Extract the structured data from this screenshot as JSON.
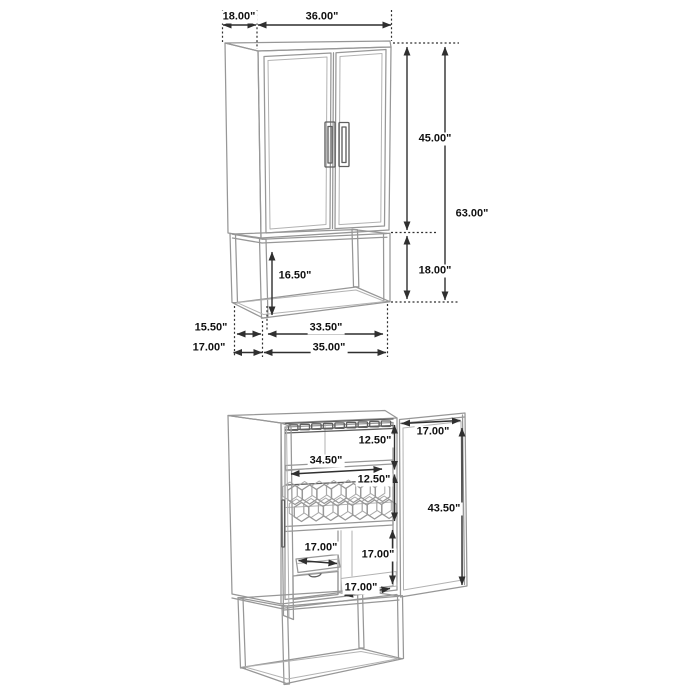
{
  "diagram_title": "bar cabinet dimension drawing, closed and open views",
  "colors": {
    "background": "#ffffff",
    "furniture_line": "#979797",
    "furniture_detail_line": "#5f5f5f",
    "dimension_line": "#2f2f2f",
    "label_text": "#111111"
  },
  "closed_view": {
    "top_depth": "18.00\"",
    "top_width": "36.00\"",
    "upper_section_height": "45.00\"",
    "overall_height": "63.00\"",
    "base_opening_height": "16.50\"",
    "base_section_height": "18.00\"",
    "base_depth_inner": "15.50\"",
    "base_depth_overall": "17.00\"",
    "base_width_inner": "33.50\"",
    "base_width_overall": "35.00\""
  },
  "open_view": {
    "door_width": "17.00\"",
    "stemware_section_height": "12.50\"",
    "interior_shelf_width": "34.50\"",
    "wine_rack_section_height": "12.50\"",
    "door_height": "43.50\"",
    "pullout_tray_width": "17.00\"",
    "lower_compartment_height": "17.00\"",
    "lower_shelf_depth": "17.00\""
  }
}
